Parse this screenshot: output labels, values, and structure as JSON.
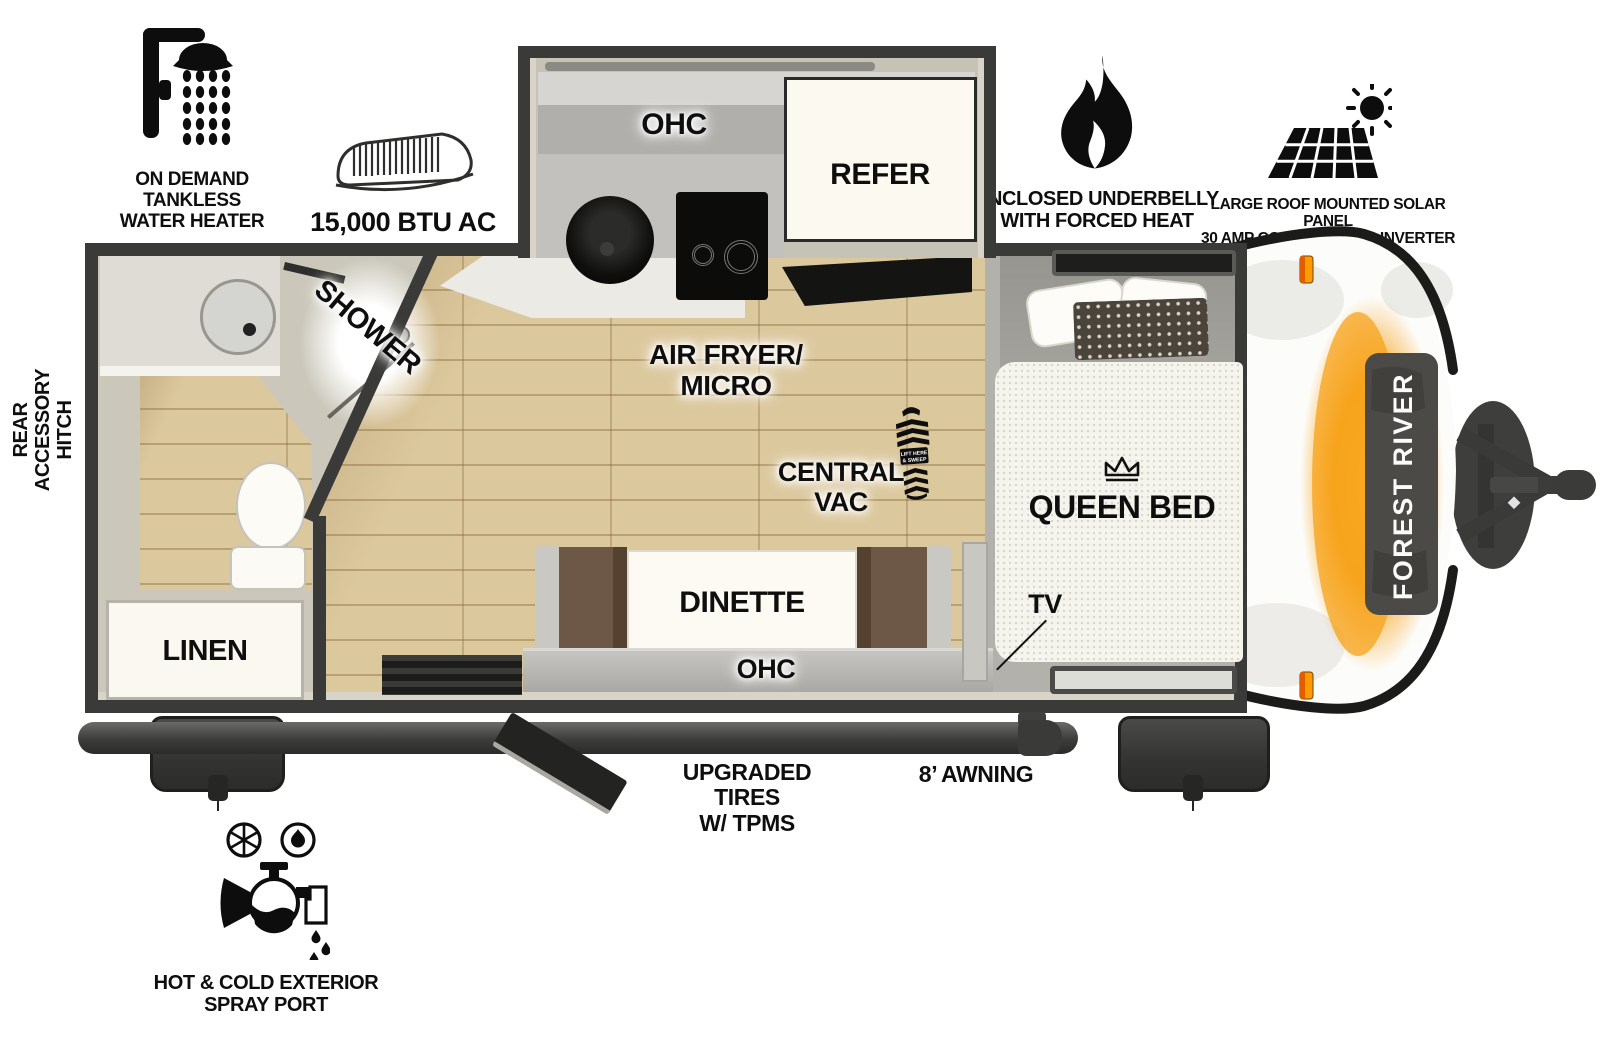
{
  "callouts": {
    "water_heater": "ON DEMAND\nTANKLESS\nWATER HEATER",
    "ac": "15,000 BTU AC",
    "underbelly": "ENCLOSED UNDERBELLY\nWITH FORCED HEAT",
    "solar": "LARGE ROOF MOUNTED SOLAR PANEL\n30 AMP CONTROLLER & INVERTER PREP",
    "rear_hitch": "REAR\nACCESSORY\nHITCH",
    "tires": "UPGRADED TIRES\nW/ TPMS",
    "awning": "8’ AWNING",
    "spray_port": "HOT & COLD EXTERIOR\nSPRAY PORT"
  },
  "floorplan": {
    "kitchen_ohc": "OHC",
    "refer": "REFER",
    "air_fryer_micro": "AIR FRYER/\nMICRO",
    "central_vac": "CENTRAL\nVAC",
    "boot_line1": "LIFT HERE",
    "boot_line2": "& SWEEP",
    "shower": "SHOWER",
    "linen": "LINEN",
    "dinette": "DINETTE",
    "dinette_ohc": "OHC",
    "queen_bed": "QUEEN BED",
    "tv": "TV"
  },
  "brand": {
    "front_cap": "FOREST RIVER"
  },
  "colors": {
    "wall": "#3a3a38",
    "floor_wood": "#dcc89d",
    "glow_orange": "#f7a31b",
    "marker_orange": "#ff9b00"
  }
}
